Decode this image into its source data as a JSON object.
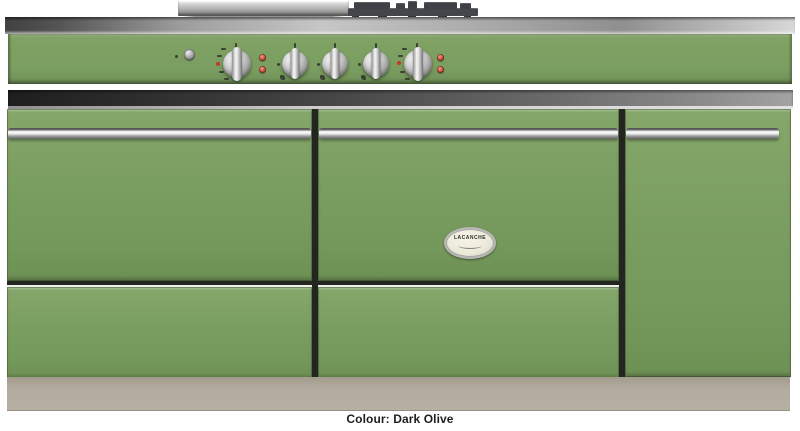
{
  "meta": {
    "subject": "Freestanding range cooker product photo, front view",
    "brand": "LACANCHE"
  },
  "caption": {
    "label": "Colour: Dark Olive"
  },
  "badge": {
    "brand": "LACANCHE"
  },
  "colors": {
    "body_green": "#7a9d61",
    "panel_green": "#81a364",
    "plinth_beige": "#b3ab9d",
    "stainless_light": "#c6c6c6",
    "trim_dark": "#2b2b2b",
    "indicator_red": "#c0392b",
    "grate_dark": "#43474c"
  },
  "cooktop": {
    "items": [
      {
        "name": "griddle-plate",
        "desc": "stainless griddle/plancha seen behind worktop edge"
      },
      {
        "name": "pan-supports",
        "desc": "dark cast-iron burner grates seen behind worktop edge"
      }
    ]
  },
  "control_panel": {
    "controls": [
      {
        "name": "ignition-button",
        "type": "push-button"
      },
      {
        "name": "left-oven-knob",
        "type": "knob",
        "scale_marks": true,
        "indicator_lights": 2
      },
      {
        "name": "burner-knob-1",
        "type": "knob"
      },
      {
        "name": "burner-knob-2",
        "type": "knob"
      },
      {
        "name": "burner-knob-3",
        "type": "knob"
      },
      {
        "name": "right-oven-knob",
        "type": "knob",
        "scale_marks": true,
        "indicator_lights": 2
      }
    ]
  },
  "cabinet": {
    "sections": [
      {
        "name": "left-oven-door",
        "handle": true,
        "drawer_below": true
      },
      {
        "name": "middle-oven-door",
        "handle": true,
        "drawer_below": true,
        "badge": true
      },
      {
        "name": "right-door",
        "handle": true,
        "drawer_below": false,
        "full_height": true
      }
    ]
  }
}
